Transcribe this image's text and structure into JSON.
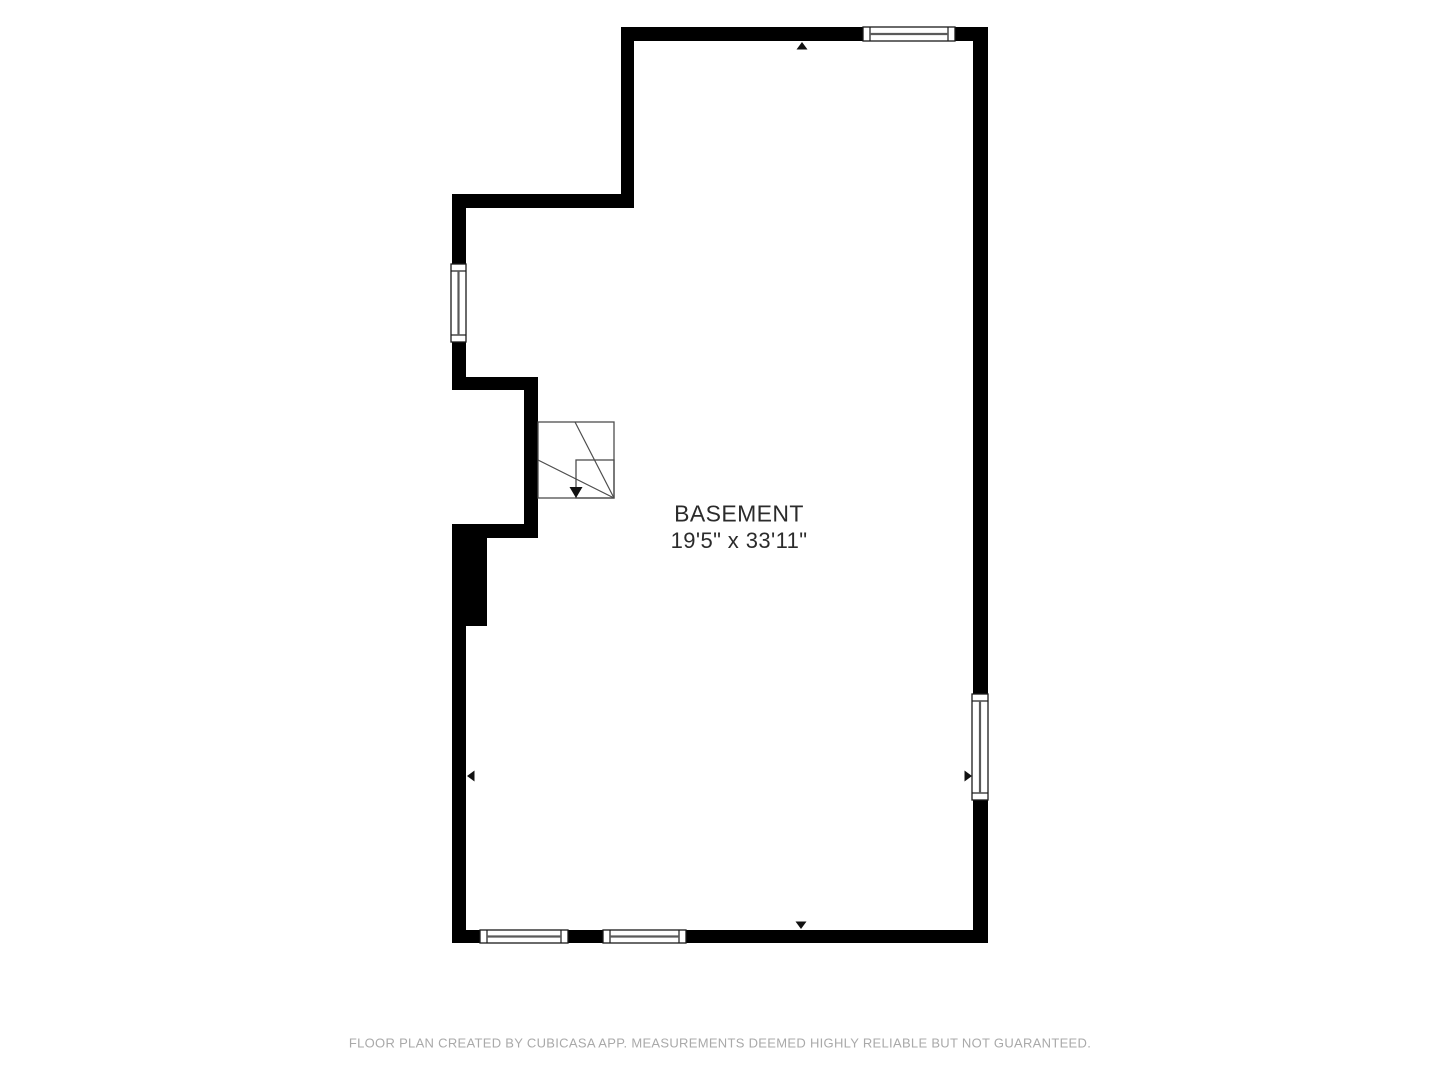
{
  "page": {
    "width": 1440,
    "height": 1080,
    "background": "#ffffff"
  },
  "floorplan": {
    "room": {
      "name": "BASEMENT",
      "dimensions": "19'5\" x 33'11\""
    },
    "colors": {
      "wall": "#000000",
      "window_fill": "#ffffff",
      "window_frame": "#1a1a1a",
      "window_center_line": "#5a5a5a",
      "stair_line": "#4d4d4d",
      "stair_arrow": "#111111",
      "marker": "#111111",
      "label_text": "#2b2b2b"
    },
    "walls": [
      {
        "name": "top-wall",
        "x": 621,
        "y": 27,
        "w": 367,
        "h": 14
      },
      {
        "name": "upper-left-wall",
        "x": 621,
        "y": 27,
        "w": 13,
        "h": 181
      },
      {
        "name": "upper-horizontal-wall",
        "x": 452,
        "y": 194,
        "w": 182,
        "h": 14
      },
      {
        "name": "left-wall-upper",
        "x": 452,
        "y": 194,
        "w": 14,
        "h": 196
      },
      {
        "name": "upper-nib-wall",
        "x": 452,
        "y": 377,
        "w": 86,
        "h": 13
      },
      {
        "name": "nib-vertical-wall",
        "x": 524,
        "y": 377,
        "w": 14,
        "h": 161
      },
      {
        "name": "lower-nib-wall",
        "x": 452,
        "y": 524,
        "w": 86,
        "h": 14
      },
      {
        "name": "thick-left-wall",
        "x": 452,
        "y": 524,
        "w": 35,
        "h": 102
      },
      {
        "name": "left-wall-lower",
        "x": 452,
        "y": 626,
        "w": 14,
        "h": 317
      },
      {
        "name": "bottom-wall",
        "x": 452,
        "y": 930,
        "w": 536,
        "h": 13
      },
      {
        "name": "right-wall",
        "x": 973,
        "y": 27,
        "w": 15,
        "h": 916
      }
    ],
    "windows": [
      {
        "name": "top-window",
        "x": 863,
        "y": 27,
        "w": 92,
        "h": 14,
        "orient": "h"
      },
      {
        "name": "left-window",
        "x": 451,
        "y": 264,
        "w": 15,
        "h": 78,
        "orient": "v"
      },
      {
        "name": "right-window",
        "x": 972,
        "y": 694,
        "w": 16,
        "h": 106,
        "orient": "v"
      },
      {
        "name": "bottom-window-1",
        "x": 480,
        "y": 930,
        "w": 88,
        "h": 13,
        "orient": "h"
      },
      {
        "name": "bottom-window-2",
        "x": 603,
        "y": 930,
        "w": 83,
        "h": 13,
        "orient": "h"
      }
    ],
    "wall_arrows": [
      {
        "direction": "up",
        "tipx": 802,
        "tipy": 42
      },
      {
        "direction": "down",
        "tipx": 801,
        "tipy": 929
      },
      {
        "direction": "left",
        "tipx": 467,
        "tipy": 776
      },
      {
        "direction": "right",
        "tipx": 972,
        "tipy": 776
      }
    ],
    "stairs": {
      "outer": {
        "x": 538,
        "y": 422,
        "w": 76,
        "h": 76
      },
      "inner": {
        "x": 576,
        "y": 460,
        "w": 38,
        "h": 38
      },
      "diagonals": [
        {
          "x1": 575,
          "y1": 422,
          "x2": 614,
          "y2": 498
        },
        {
          "x1": 538,
          "y1": 460,
          "x2": 614,
          "y2": 498
        }
      ],
      "arrow": {
        "tipx": 576,
        "tipy": 498,
        "halfw": 6.5,
        "depth": 11
      }
    }
  },
  "footer": {
    "disclaimer": "FLOOR PLAN CREATED BY CUBICASA APP. MEASUREMENTS DEEMED HIGHLY RELIABLE BUT NOT GUARANTEED."
  }
}
